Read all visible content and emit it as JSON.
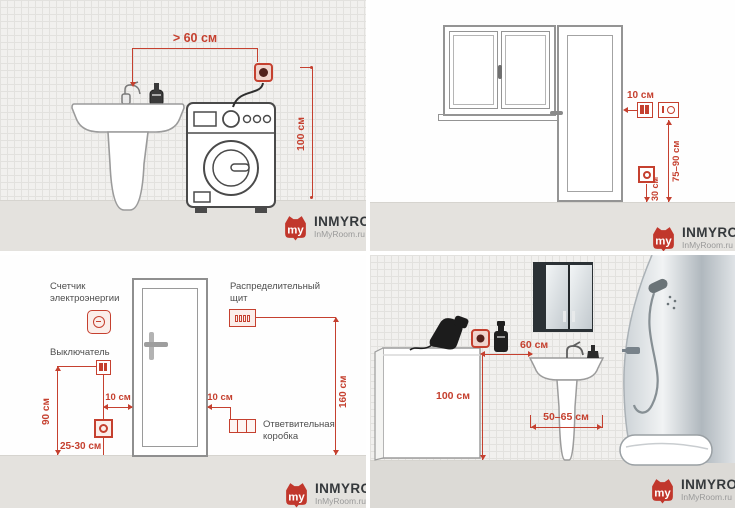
{
  "colors": {
    "accent": "#c5402f",
    "logo_red": "#c1372c",
    "label_gray": "#4e4e4e"
  },
  "brand": {
    "monogram": "my",
    "name": "INMYROOM",
    "site": "InMyRoom.ru"
  },
  "q1": {
    "dim_distance": "> 60 см",
    "dim_height": "100 см"
  },
  "q2": {
    "dim_gap": "10 см",
    "dim_range": "75–90 см",
    "dim_low": "30 см"
  },
  "q3": {
    "meter_line1": "Счетчик",
    "meter_line2": "электроэнергии",
    "switch_label": "Выключатель",
    "dim_switch": "90 см",
    "dim_gap_left": "10 см",
    "dim_outlet": "25-30 см",
    "panel_line1": "Распределительный",
    "panel_line2": "щит",
    "dim_panel": "160 см",
    "dim_gap_right": "10 см",
    "junction_line1": "Ответвительная",
    "junction_line2": "коробка"
  },
  "q4": {
    "dim_gap": "60 см",
    "dim_height": "100 см",
    "dim_width": "50–65 см"
  }
}
